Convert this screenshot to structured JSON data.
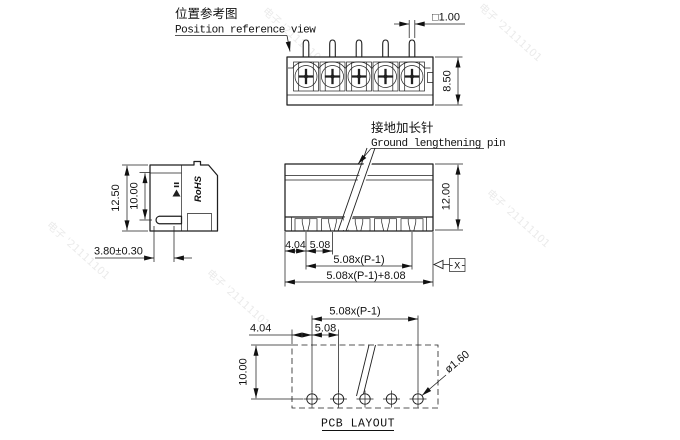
{
  "watermark": {
    "text": "电子 '21111101",
    "color": "#ebebeb"
  },
  "top_view": {
    "label_cn": "位置参考图",
    "label_en": "Position reference view",
    "dim_pin_square": "□1.00",
    "dim_body_height": "8.50"
  },
  "side_view": {
    "dim_total_height": "12.50",
    "dim_pin_offset": "10.00",
    "dim_pin_length": "3.80±0.30",
    "marking": "RoHS"
  },
  "front_view": {
    "callout_cn": "接地加长针",
    "callout_en": "Ground lengthening pin",
    "dim_height": "12.00",
    "dim_end_to_pin": "4.04",
    "dim_pitch": "5.08",
    "dim_pin_span": "5.08x(P-1)",
    "dim_total_width": "5.08x(P-1)+8.08",
    "datum_label": "-X-"
  },
  "pcb_layout": {
    "title": "PCB LAYOUT",
    "dim_hole_span": "5.08x(P-1)",
    "dim_edge_to_hole": "4.04",
    "dim_pitch": "5.08",
    "dim_row_offset": "10.00",
    "dim_hole_diameter": "ø1.60"
  }
}
